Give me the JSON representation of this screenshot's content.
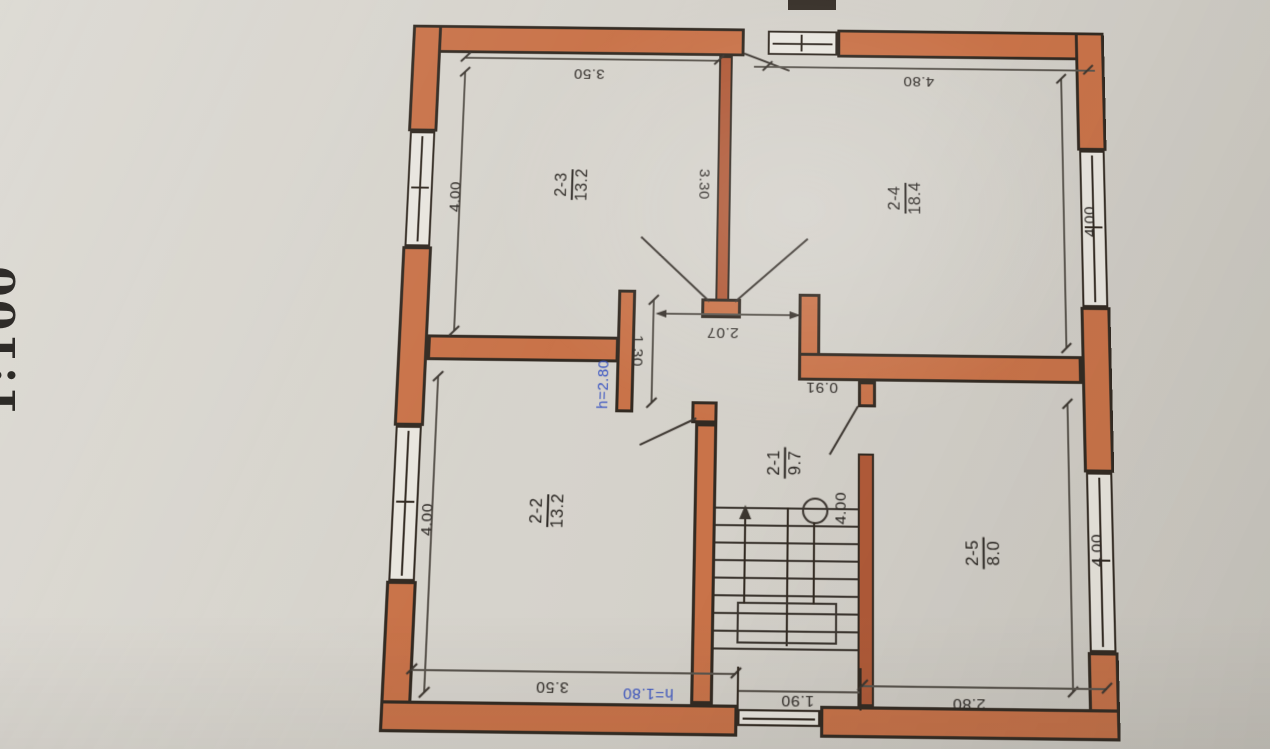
{
  "drawing": {
    "type": "floor-plan",
    "scale_label": "1:100",
    "rooms": [
      {
        "id": "2-3",
        "area": "13.2"
      },
      {
        "id": "2-4",
        "area": "18.4"
      },
      {
        "id": "2-2",
        "area": "13.2"
      },
      {
        "id": "2-1",
        "area": "9.7"
      },
      {
        "id": "2-5",
        "area": "8.0"
      }
    ],
    "dims": {
      "top_left": "3.50",
      "top_right": "4.80",
      "left_upper": "4.00",
      "left_lower": "4.00",
      "right_upper": "4.00",
      "right_lower": "4.00",
      "inner_wall": "3.30",
      "hall_opening": "2.07",
      "hall_stub": "1.30",
      "door_step": "0.91",
      "stair": "4.00",
      "bottom_left": "3.50",
      "bottom_stair": "1.90",
      "bottom_right": "2.80"
    },
    "notes": {
      "room_height": "h=2.80",
      "opening_height": "h=1.80"
    },
    "colors": {
      "wall_fill": "#c97349",
      "wall_outline": "#322a22",
      "paper": "#d6d3cc",
      "annotation_blue": "#3b55c2"
    }
  }
}
